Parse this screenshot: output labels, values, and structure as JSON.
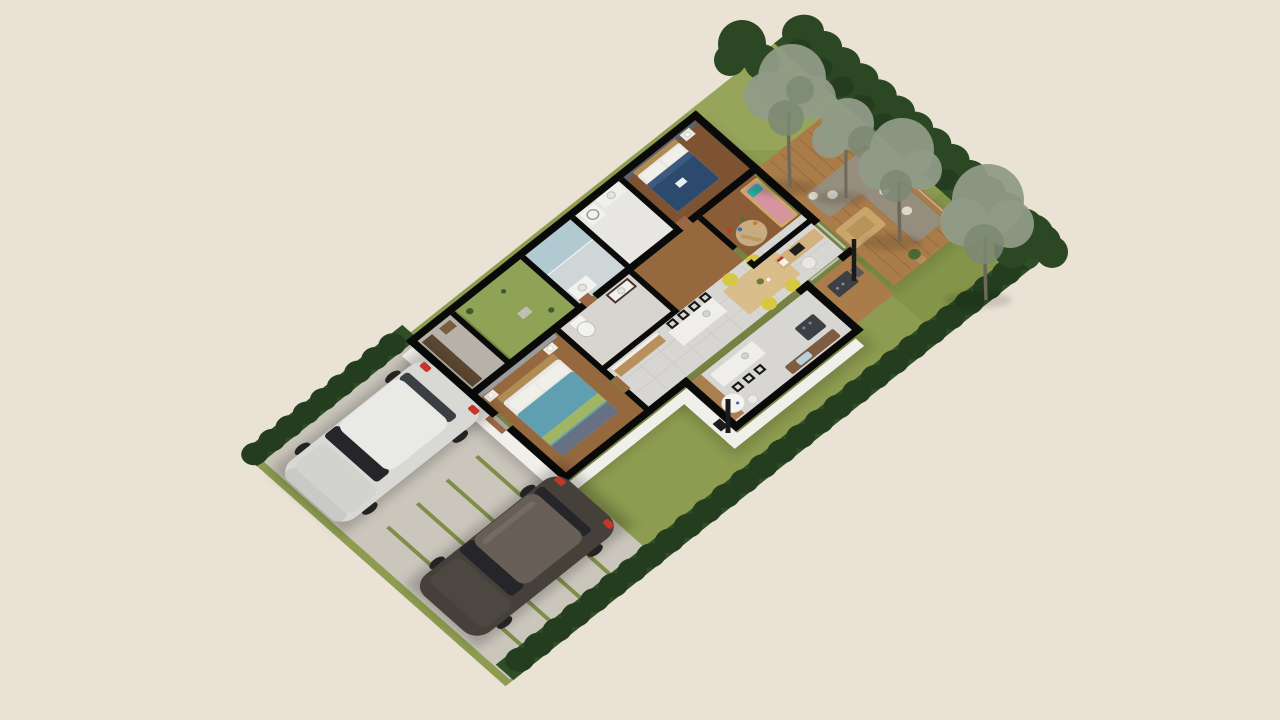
{
  "scene": {
    "description": "Isometric 3D floor plan render of a single-storey house with garden, hedges, birch trees, paved driveway and two parked cars",
    "style": "architectural-3d-render",
    "no_visible_text": true
  },
  "palette": {
    "background": "#e9e2d5",
    "lawn": "#8d9c50",
    "lawn_light": "#a0ae63",
    "lawn_dark": "#78893f",
    "hedge": "#2f4d27",
    "hedge_dark": "#243d1e",
    "bush": "#2c4724",
    "birch_foliage": "#909b87",
    "birch_foliage_dark": "#7b8874",
    "birch_trunk": "#6e675c",
    "concrete": "#cac6bc",
    "paver_joint": "#7e8e49",
    "exterior_wall": "#f1efe9",
    "wall_top": "#0a0a0a",
    "interior_wall_accent": "#5a6170",
    "wood_door": "#9c6743",
    "deck_wood": "#a97c4a",
    "deck_line": "#8a5f33",
    "floor_master": "#96683e",
    "floor_bedroom": "#7d5332",
    "floor_kids": "#8a5c38",
    "tile": "#d7d6d2",
    "tile_line": "#c3c2bd",
    "laundry_floor": "#e7e6e2",
    "closet_floor": "#b6b2aa",
    "bath_floor": "#cfd6d8",
    "mosaic_floor": "#d8d4cf",
    "shower_blue": "#a9c6cf",
    "courtyard_grass": "#8ea355",
    "wardrobe": "#5a4631",
    "cabinet_wood": "#a97f50",
    "counter_wood": "#b8905e",
    "island_white": "#efeeea",
    "appliance": "#3c4044",
    "bench": "#7d5c41",
    "blanket": "#b7d2da",
    "hex_table": "#f4f3f0",
    "sofa": "#968e7d",
    "cushion": "#ddd8cc",
    "coffee_table": "#c8a66b",
    "stove": "#1c1c1c",
    "dining_table": "#d9bd8b",
    "chair_yellow": "#d7c842",
    "desk": "#d3b17d",
    "laptop": "#1f1f1f",
    "bed_navy": "#2c4a6e",
    "bed_teal": "#5f9fb1",
    "bed_lime": "#a9b75e",
    "bed_throw": "#687083",
    "bed_pink": "#d694a1",
    "pillow_teal": "#2faaa2",
    "headboard": "#b08b54",
    "crib_wood": "#cfa76a",
    "pillow_white": "#f0efea",
    "rug": "#cdb489",
    "toilet_white": "#f2f2ef",
    "vanity_dark": "#43332a",
    "car_silver": "#d8d8d5",
    "car_silver_roof": "#e9e9e6",
    "car_dark": "#45403a",
    "car_dark_roof": "#675f55",
    "car_glass": "#26262a",
    "taillight": "#c23728",
    "wheel": "#232323"
  },
  "rooms": [
    {
      "id": "master-bedroom",
      "label": "Master bedroom with teal double bed"
    },
    {
      "id": "second-bedroom",
      "label": "Bedroom with navy double bed"
    },
    {
      "id": "kids-room",
      "label": "Kids room with cot and play rug"
    },
    {
      "id": "shower-bathroom",
      "label": "Bathroom with walk-in shower"
    },
    {
      "id": "family-bathroom",
      "label": "Bathroom with toilet and dark vanity"
    },
    {
      "id": "laundry",
      "label": "Laundry with washing machine"
    },
    {
      "id": "walk-in-closet",
      "label": "Walk-in closet"
    },
    {
      "id": "inner-courtyard",
      "label": "Planted inner courtyard"
    },
    {
      "id": "hallway",
      "label": "Hallway"
    },
    {
      "id": "kitchen-dining",
      "label": "Open kitchen and dining with island and yellow chairs"
    },
    {
      "id": "breakfast-kitchen",
      "label": "Kitchen wing with island, breakfast table and bench"
    },
    {
      "id": "living-terrace",
      "label": "Living terrace with corner sofa and coffee table"
    },
    {
      "id": "bbq-deck",
      "label": "Barbecue deck with grill"
    }
  ],
  "vehicles": [
    {
      "id": "silver-hatchback",
      "label": "Silver hatchback parked on driveway"
    },
    {
      "id": "dark-hatchback",
      "label": "Dark brown hatchback parked on driveway"
    }
  ],
  "landscape": {
    "features": [
      "lawn garden",
      "clipped hedge borders",
      "four birch trees",
      "paved driveway with grass joints",
      "inner courtyard planting"
    ]
  }
}
